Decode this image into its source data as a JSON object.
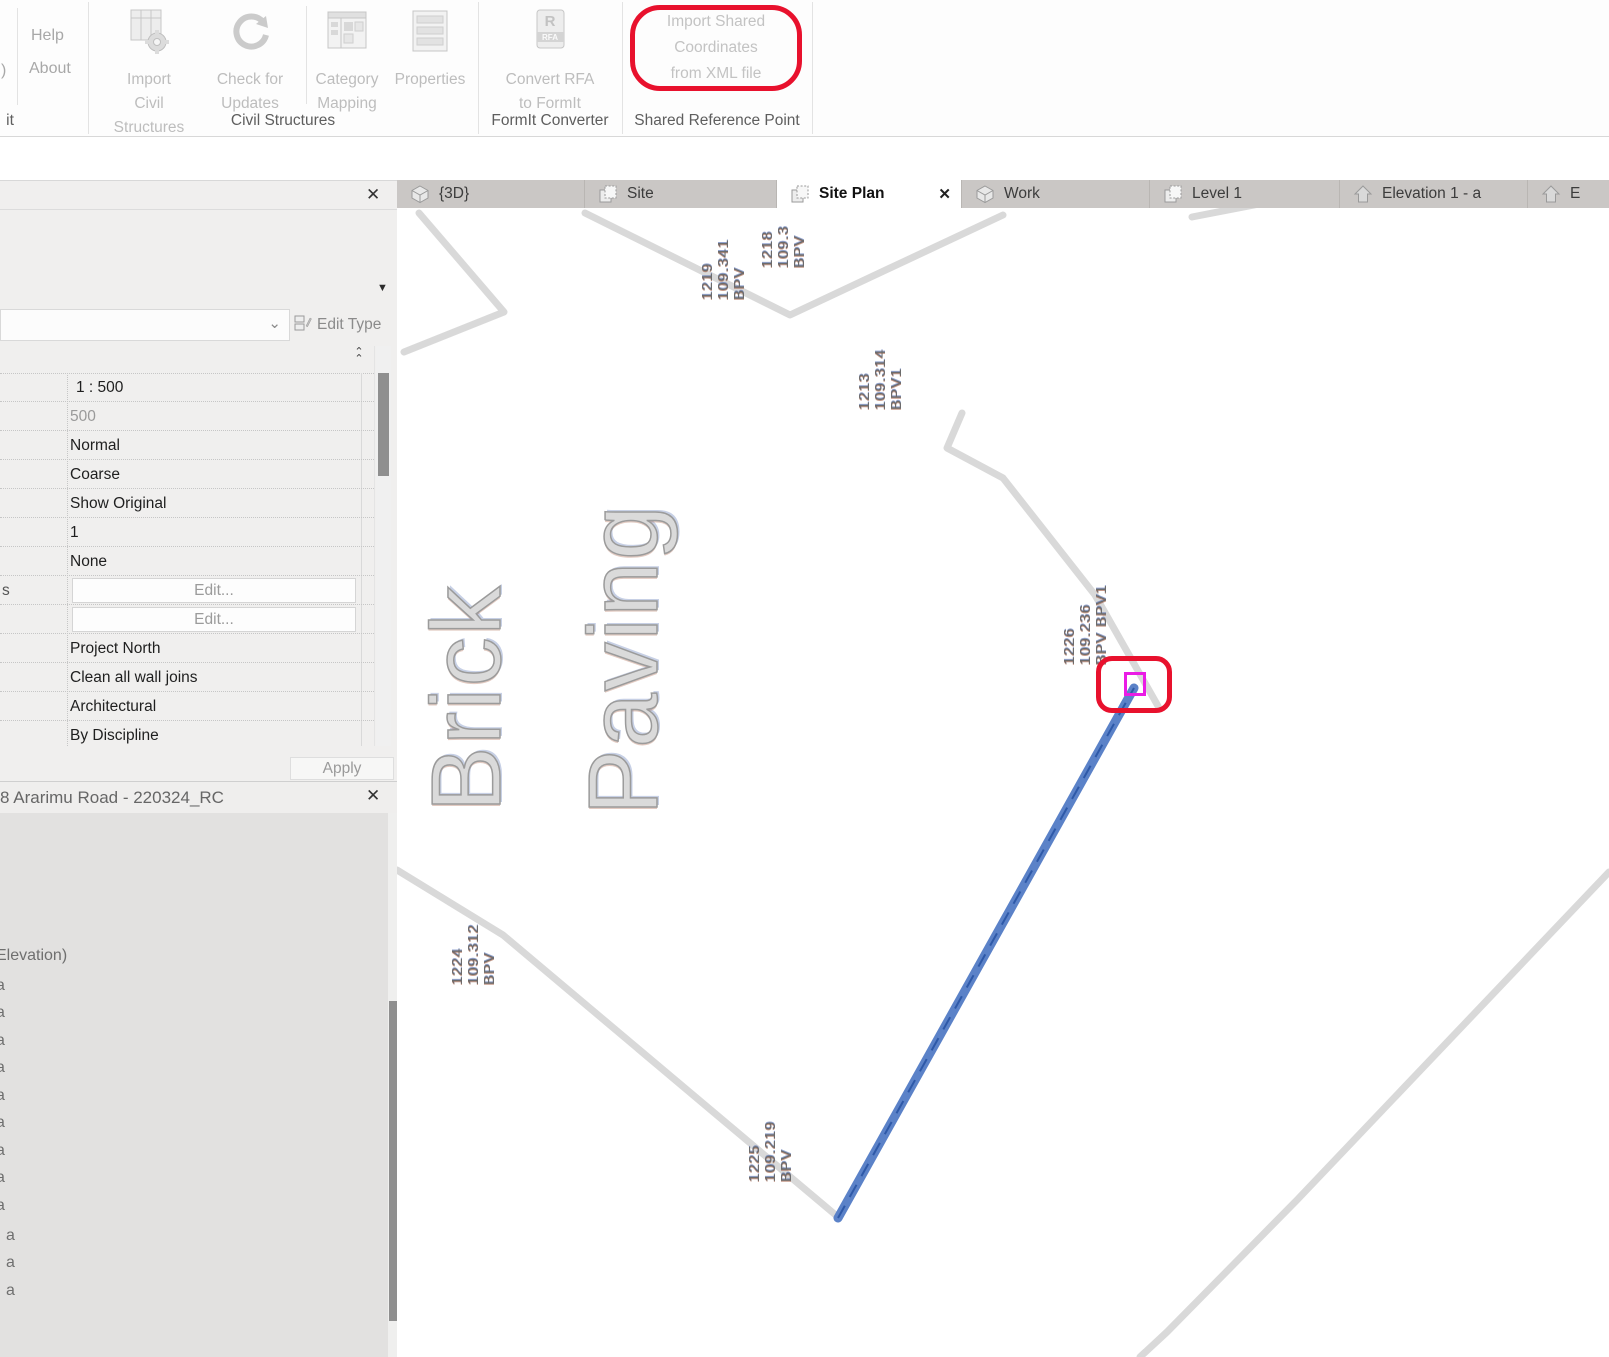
{
  "icons": {
    "close": "✕",
    "dropdown": "▼",
    "combo_chevron": "⌄",
    "caret_up": "⌃"
  },
  "colors": {
    "annotation_red": "#e8112d",
    "point_magenta": "#ea1ce5",
    "line_blue": "#5b82c8",
    "line_gray": "#d9d9d9"
  },
  "ribbon": {
    "partial_left_label": ")",
    "partial_left_group": "it",
    "help_label": "Help",
    "about_label": "About",
    "import_civil": {
      "line1": "Import",
      "line2": "Civil Structures"
    },
    "check_updates": {
      "line1": "Check for",
      "line2": "Updates"
    },
    "category_mapping": {
      "line1": "Category",
      "line2": "Mapping"
    },
    "properties_label": "Properties",
    "convert_rfa": {
      "line1": "Convert RFA",
      "line2": "to FormIt"
    },
    "import_shared": {
      "line1": "Import Shared",
      "line2": "Coordinates",
      "line3": "from XML file"
    },
    "group_civil": "Civil Structures",
    "group_formit": "FormIt Converter",
    "group_shared": "Shared Reference Point"
  },
  "tabs": {
    "items": [
      {
        "label": "{3D}"
      },
      {
        "label": "Site"
      },
      {
        "label": "Site Plan"
      },
      {
        "label": "Work"
      },
      {
        "label": "Level 1"
      },
      {
        "label": "Elevation 1 - a"
      },
      {
        "label": "E"
      }
    ]
  },
  "properties": {
    "edit_type_label": "Edit Type",
    "row_label_fragment": "s",
    "apply_label": "Apply",
    "rows": [
      {
        "value": "1 : 500"
      },
      {
        "value": "500"
      },
      {
        "value": "Normal"
      },
      {
        "value": "Coarse"
      },
      {
        "value": "Show Original"
      },
      {
        "value": "1"
      },
      {
        "value": "None"
      },
      {
        "value": "Edit..."
      },
      {
        "value": "Edit..."
      },
      {
        "value": "Project North"
      },
      {
        "value": "Clean all wall joins"
      },
      {
        "value": "Architectural"
      },
      {
        "value": "By Discipline"
      }
    ]
  },
  "project_browser": {
    "title": "8 Ararimu Road - 220324_RC",
    "section_label": "Elevation)",
    "items": [
      "a",
      "a",
      "a",
      "a",
      "a",
      "a",
      "a",
      "a",
      "a"
    ],
    "sub_items": [
      "a",
      "a",
      "a"
    ]
  },
  "canvas": {
    "big_text": {
      "line1": "Brick",
      "line2": "Paving"
    },
    "survey_labels": [
      {
        "num": "1219",
        "elev": "109.341",
        "code": "BPV"
      },
      {
        "num": "1218",
        "elev": "109.3",
        "code": "BPV"
      },
      {
        "num": "1213",
        "elev": "109.314",
        "code": "BPV1"
      },
      {
        "num": "1226",
        "elev": "109.236",
        "code": "BPV BPV1"
      },
      {
        "num": "1224",
        "elev": "109.312",
        "code": "BPV"
      },
      {
        "num": "1225",
        "elev": "109.219",
        "code": "BPV"
      }
    ]
  }
}
